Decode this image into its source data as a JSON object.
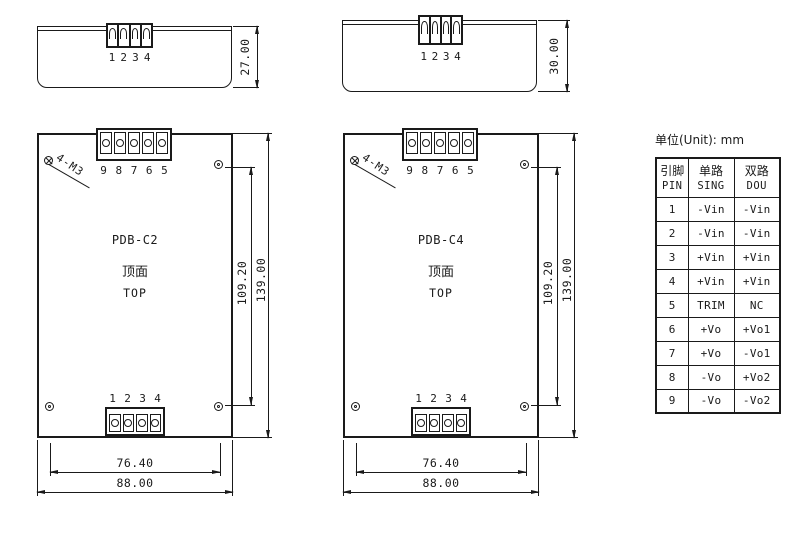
{
  "unit_label": "单位(Unit): mm",
  "modules": {
    "left": {
      "name": "PDB-C2",
      "face_cn": "顶面",
      "face_en": "TOP",
      "screw_label": "4-M3",
      "side_height_mm": "27.00",
      "top_pins": [
        "9",
        "8",
        "7",
        "6",
        "5"
      ],
      "bottom_pins": [
        "1",
        "2",
        "3",
        "4"
      ],
      "dims": {
        "inner_height": "109.20",
        "outer_height": "139.00",
        "inner_width": "76.40",
        "outer_width": "88.00"
      }
    },
    "right": {
      "name": "PDB-C4",
      "face_cn": "顶面",
      "face_en": "TOP",
      "screw_label": "4-M3",
      "side_height_mm": "30.00",
      "top_pins": [
        "9",
        "8",
        "7",
        "6",
        "5"
      ],
      "bottom_pins": [
        "1",
        "2",
        "3",
        "4"
      ],
      "dims": {
        "inner_height": "109.20",
        "outer_height": "139.00",
        "inner_width": "76.40",
        "outer_width": "88.00"
      }
    }
  },
  "pin_table": {
    "col_headers": [
      {
        "cn": "引脚",
        "en": "PIN"
      },
      {
        "cn": "单路",
        "en": "SING"
      },
      {
        "cn": "双路",
        "en": "DOU"
      }
    ],
    "rows": [
      {
        "pin": "1",
        "sing": "-Vin",
        "dou": "-Vin"
      },
      {
        "pin": "2",
        "sing": "-Vin",
        "dou": "-Vin"
      },
      {
        "pin": "3",
        "sing": "+Vin",
        "dou": "+Vin"
      },
      {
        "pin": "4",
        "sing": "+Vin",
        "dou": "+Vin"
      },
      {
        "pin": "5",
        "sing": "TRIM",
        "dou": "NC"
      },
      {
        "pin": "6",
        "sing": "+Vo",
        "dou": "+Vo1"
      },
      {
        "pin": "7",
        "sing": "+Vo",
        "dou": "-Vo1"
      },
      {
        "pin": "8",
        "sing": "-Vo",
        "dou": "+Vo2"
      },
      {
        "pin": "9",
        "sing": "-Vo",
        "dou": "-Vo2"
      }
    ]
  }
}
